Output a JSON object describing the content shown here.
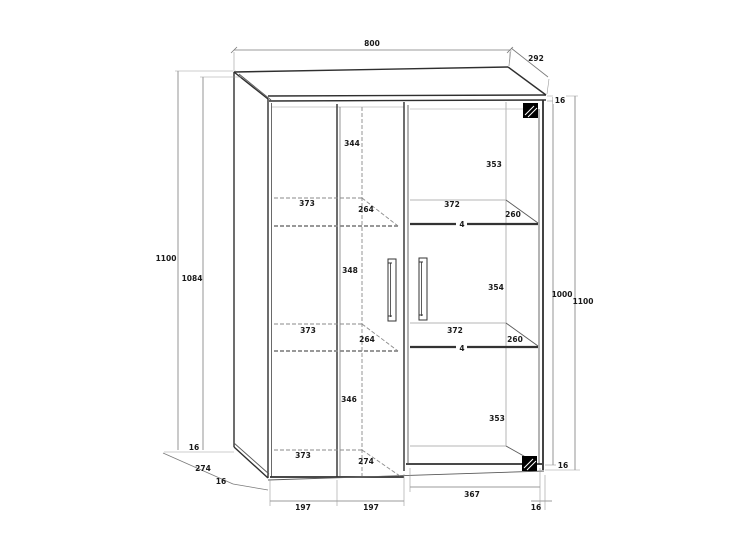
{
  "page": {
    "background": "#ffffff"
  },
  "drawing": {
    "kind": "furniture-technical-drawing",
    "object": "display cabinet, perspective front view with dimensions",
    "colors": {
      "outline": "#2f2f2f",
      "hidden_lines": "#8a8a8a",
      "glass_edges": "#b5b5b5",
      "dimension_lines": "#7a7a7a",
      "text": "#1a1a1a",
      "hinge_block": "#000000",
      "background": "#ffffff"
    },
    "labels": {
      "top_width": "800",
      "top_depth": "292",
      "top_thickness": "16",
      "left_total_height": "1100",
      "left_carcass_height": "1084",
      "left_comp1_height": "344",
      "left_shelf1_width": "373",
      "left_shelf1_depth": "264",
      "left_comp2_height": "348",
      "left_shelf2_width": "373",
      "left_shelf2_depth": "264",
      "left_comp3_height": "346",
      "left_bottom_width": "373",
      "left_bottom_depth": "274",
      "right_comp1_height": "353",
      "right_shelf1_width": "372",
      "right_shelf1_depth": "260",
      "right_shelf1_thickness": "4",
      "right_comp2_height": "354",
      "right_shelf2_width": "372",
      "right_shelf2_depth": "260",
      "right_shelf2_thickness": "4",
      "right_comp3_height": "353",
      "right_inner_height": "1000",
      "right_total_height": "1100",
      "right_bottom_thickness": "16",
      "bottom_left_board_thickness": "16",
      "bottom_left_depth": "274",
      "bottom_left_side_thickness": "16",
      "door1_width": "197",
      "door2_width": "197",
      "glass_door_width": "367",
      "bottom_right_side_thickness": "16"
    }
  }
}
